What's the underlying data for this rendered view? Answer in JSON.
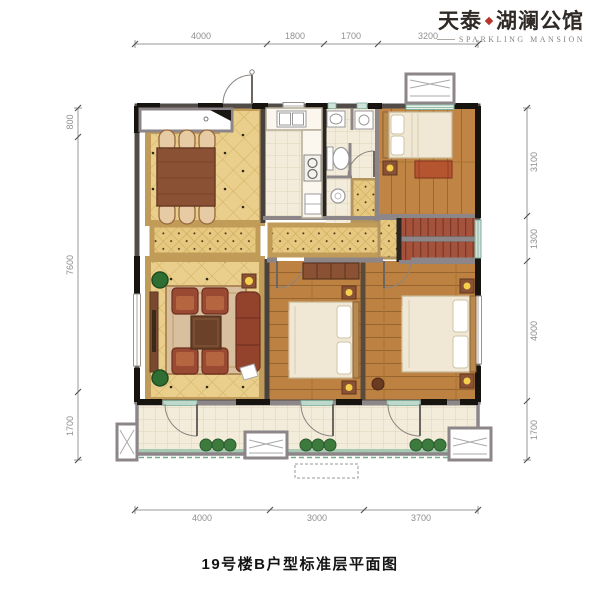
{
  "logo": {
    "brand_cn_1": "天泰",
    "brand_cn_2": "湖澜公馆",
    "brand_en": "SPARKLING MANSION"
  },
  "caption": "19号楼B户型标准层平面图",
  "dims": {
    "top": [
      "4000",
      "1800",
      "1700",
      "3200"
    ],
    "bottom": [
      "4000",
      "3000",
      "3700"
    ],
    "left": [
      "800",
      "7600",
      "1700"
    ],
    "right": [
      "3100",
      "1300",
      "4000",
      "1700"
    ]
  },
  "colors": {
    "accent_red": "#b5352a",
    "tile_yellow": "#e9cf8b",
    "wood": "#c08544",
    "wall_dark": "#17130f",
    "wall_gray": "#8d8689",
    "window_teal": "#7fae9b",
    "planter_green": "#a6cbb2"
  }
}
